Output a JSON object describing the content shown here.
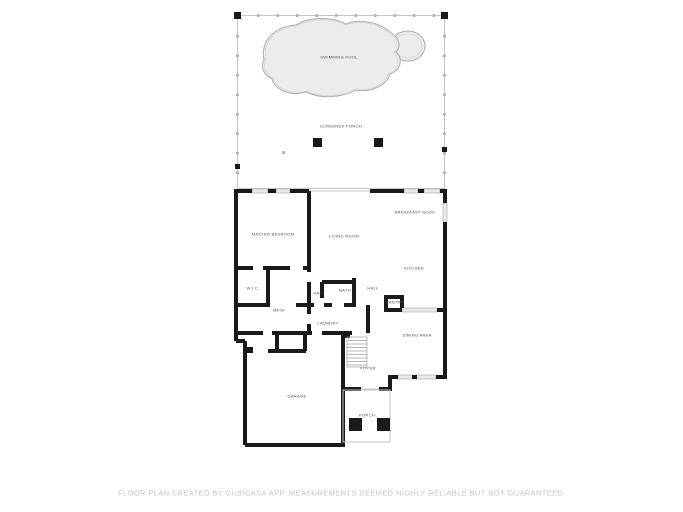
{
  "colors": {
    "wall": "#1a1a1a",
    "window_fill": "#e9e9e9",
    "window_edge": "#a6a6a6",
    "thin_line": "#c6c6c6",
    "mesh": "#b5b5b5",
    "pool_fill": "#ececec",
    "pool_edge": "#aeaeae",
    "pool_inner": "#d4d4d4",
    "stair": "#a3a3a3",
    "label_text": "#4a4a4a",
    "footer_text": "#c3c3c3"
  },
  "rooms": [
    {
      "id": "swimming-pool",
      "label": "SWIMMING POOL"
    },
    {
      "id": "screened-porch",
      "label": "SCREENED PORCH"
    },
    {
      "id": "master-bedroom",
      "label": "MASTER BEDROOM"
    },
    {
      "id": "living-room",
      "label": "LIVING ROOM"
    },
    {
      "id": "breakfast-nook",
      "label": "BREAKFAST NOOK"
    },
    {
      "id": "kitchen",
      "label": "KITCHEN"
    },
    {
      "id": "wic",
      "label": "W.I.C."
    },
    {
      "id": "master-bath",
      "label": "BATH"
    },
    {
      "id": "hall-left",
      "label": "HALL"
    },
    {
      "id": "bath-2",
      "label": "BATH"
    },
    {
      "id": "hall-right",
      "label": "HALL"
    },
    {
      "id": "pantry",
      "label": "PANTRY"
    },
    {
      "id": "laundry",
      "label": "LAUNDRY"
    },
    {
      "id": "dining-area",
      "label": "DINING AREA"
    },
    {
      "id": "foyer",
      "label": "FOYER"
    },
    {
      "id": "garage",
      "label": "GARAGE"
    },
    {
      "id": "porch",
      "label": "PORCH"
    }
  ],
  "footer": {
    "disclaimer": "FLOOR PLAN CREATED BY CUBICASA APP. MEASUREMENTS DEEMED HIGHLY RELIABLE BUT NOT GUARANTEED."
  }
}
